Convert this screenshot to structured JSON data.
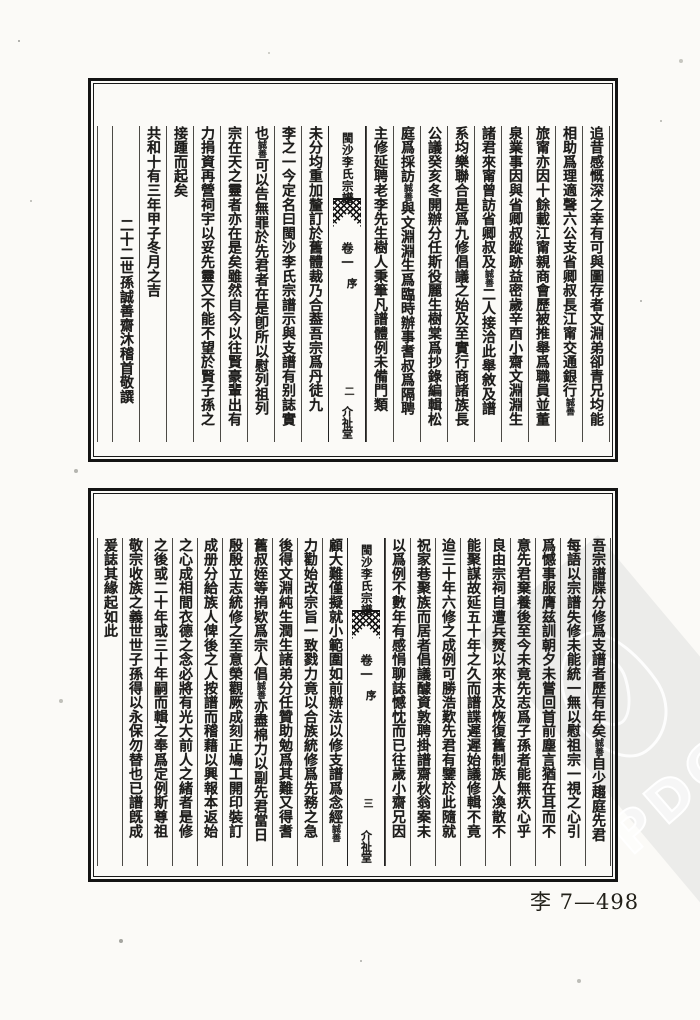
{
  "document": {
    "watermark_label": "PDG",
    "catalog_number": "李 7—498"
  },
  "top_page": {
    "banxin": {
      "title": "閩沙李氏宗譜",
      "juan": "卷一",
      "section": "序",
      "page_no": "二",
      "hall": "介祉堂"
    },
    "columns": [
      {
        "text": "首爲小齋兄賀成曾幾何時而小齋墓又宿草矣撫今"
      },
      {
        "text": "追昔感慨深之幸有可與圖存者文淵弟卻青兄均能"
      },
      {
        "text": "相助爲理適聲六公支省卿叔長江甯交通銀行",
        "note": "誠善"
      },
      {
        "text": "旅甯亦因十餘載江甯親商會歷被推舉爲職員並董"
      },
      {
        "text": "泉業事因與省卿叔蹤跡益密歲辛酉小齋文淵淵生"
      },
      {
        "text": "諸君來甯曾訪省卿叔及",
        "note": "誠善",
        "text2": "二人接洽此舉敘及譜"
      },
      {
        "text": "系均樂聯合是爲九修倡議之始及至實行商諸族長"
      },
      {
        "text": "公議癸亥冬開辦分任斯役麗生樹棠爲抄錄編輯松"
      },
      {
        "text": "庭爲採訪",
        "note": "誠善",
        "text2": "與文淵淵生爲臨時辦事耆叔爲隔聘"
      },
      {
        "text": "主修延聘老李先生樹人秉筆凡譜體例未備門類"
      },
      {
        "text": "未分均重加釐訂於舊體裁乃合葢吾宗爲丹徒九"
      },
      {
        "text": "李之一今定名曰閩沙李氏宗譜示與支譜有别誌實"
      },
      {
        "text": "也",
        "note": "誠善",
        "text2": "可以告無罪於先君者在是卽所以慰列祖列"
      },
      {
        "text": "宗在天之靈者亦在是矣雖然自今以往賢豪輩出有"
      },
      {
        "text": "力捐資再營祠宇以妥先靈又不能不望於賢子孫之"
      },
      {
        "text": "接踵而起矣"
      },
      {
        "text": "共和十有三年甲子冬月之吉"
      },
      {
        "text": "二十二世孫誠善齋沐稽首敬譔"
      }
    ]
  },
  "bottom_page": {
    "banxin": {
      "title": "閩沙李氏宗譜",
      "juan": "卷一",
      "section": "序",
      "page_no": "三",
      "hall": "介祉堂"
    },
    "columns": [
      {
        "text": "九修宗譜序"
      },
      {
        "text": "吾宗譜牒分修爲支譜者歷有年矣",
        "note": "誠善",
        "text2": "自少趨庭先君"
      },
      {
        "text": "每語以宗譜失修未能統一無以慰祖宗一視之心引"
      },
      {
        "text": "爲憾事服膺兹訓朝夕未嘗回首前塵言猶在耳而不"
      },
      {
        "text": "意先君棄養後至今未竟先志爲子孫者能無疚心乎"
      },
      {
        "text": "良由宗祠自遭兵燹以來未及恢復舊制族人渙散不"
      },
      {
        "text": "能聚謀故延五十年之久而譜諜遲遲始議修輯不竟"
      },
      {
        "text": "迨三十年六修之成例可勝浩歎先君有鑒於此隨就"
      },
      {
        "text": "祝家巷聚族而居者倡議醵資敦聘掛譜齋秋翁案未"
      },
      {
        "text": "以爲例不數年有感悁聊誌憾忱而已往歲小齋兄因"
      },
      {
        "text": "顧大難僅擬就小範圍如前辦法以修支譜爲念經",
        "note": "誠善"
      },
      {
        "text": "力勸始改宗旨一致戮力竟以合族統修爲先務之急"
      },
      {
        "text": "後得文淵純生潤生諸弟分任贊助勉爲其難又得耆"
      },
      {
        "text": "舊叔姪等捐欵爲宗人倡",
        "note": "誠善",
        "text2": "亦盡棉力以副先君當日"
      },
      {
        "text": "殷殷立志統修之至意榮觀厥成刻正鳩工開印裝訂"
      },
      {
        "text": "成册分給族人俾後之人按譜而稽藉以興報本返始"
      },
      {
        "text": "之心成相間衣德之念必將有光大前人之緒者是修"
      },
      {
        "text": "之後或二十年或三十年嗣而輯之奉爲定例斯尊祖"
      },
      {
        "text": "敬宗收族之義世世子孫得以永保勿替也已譜旣成"
      },
      {
        "text": "爰誌其緣起如此"
      }
    ]
  }
}
